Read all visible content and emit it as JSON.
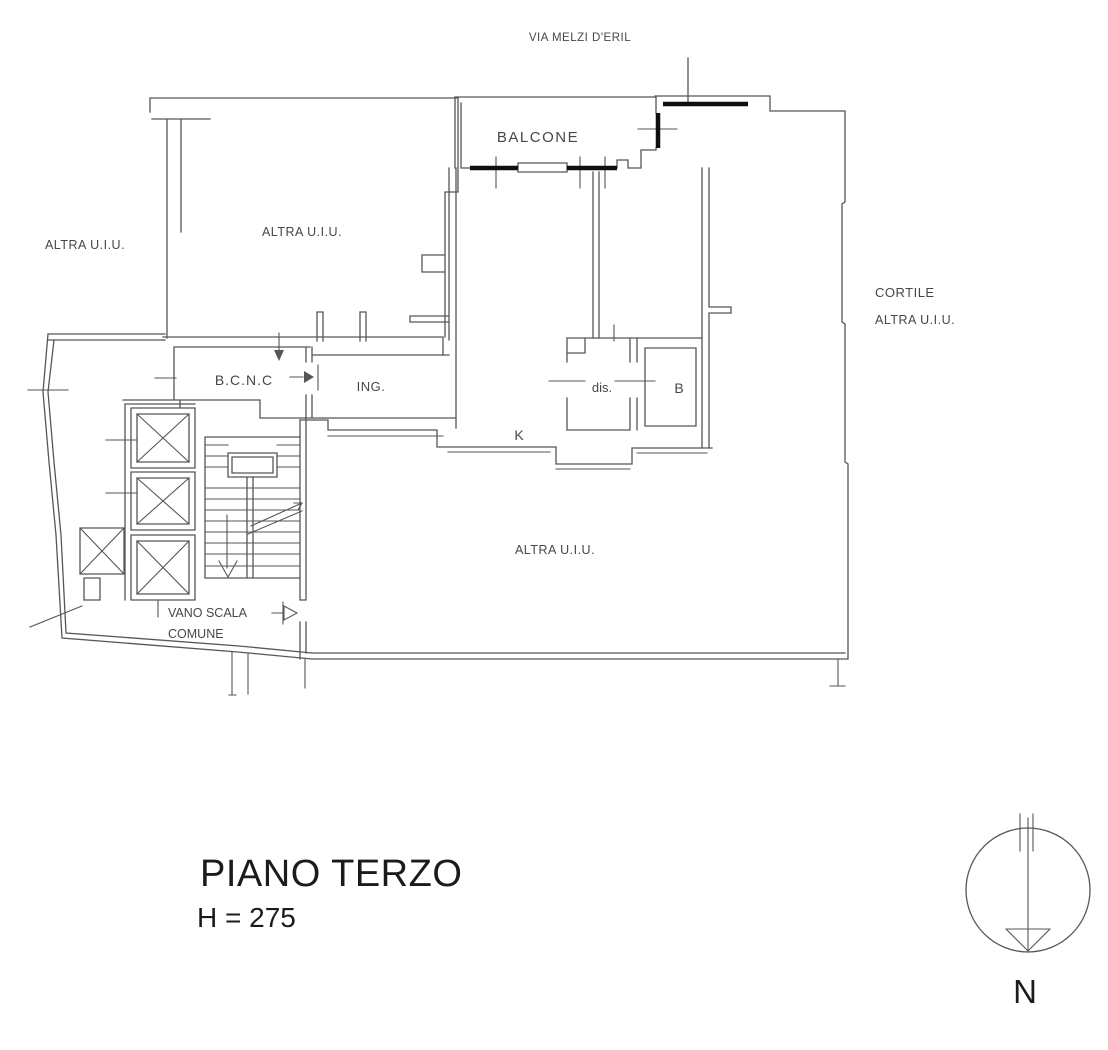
{
  "colors": {
    "background": "#ffffff",
    "wall": "#565656",
    "wall_thick": "#0f0f0f",
    "text": "#474747",
    "title_text": "#1b1b1b"
  },
  "street": {
    "name": "VIA MELZI D'ERIL"
  },
  "rooms": {
    "balcone": "BALCONE",
    "bcnc": "B.C.N.C",
    "ingresso": "ING.",
    "disimpegno": "dis.",
    "bagno": "B",
    "cucina": "K"
  },
  "other_units": {
    "left": "ALTRA U.I.U.",
    "top": "ALTRA U.I.U.",
    "bottom": "ALTRA U.I.U."
  },
  "courtyard": {
    "line1": "CORTILE",
    "line2": "ALTRA U.I.U."
  },
  "stairwell": {
    "line1": "VANO SCALA",
    "line2": "COMUNE"
  },
  "caption": {
    "floor_title": "PIANO TERZO",
    "floor_height": "H = 275"
  },
  "compass": {
    "north_label": "N"
  }
}
